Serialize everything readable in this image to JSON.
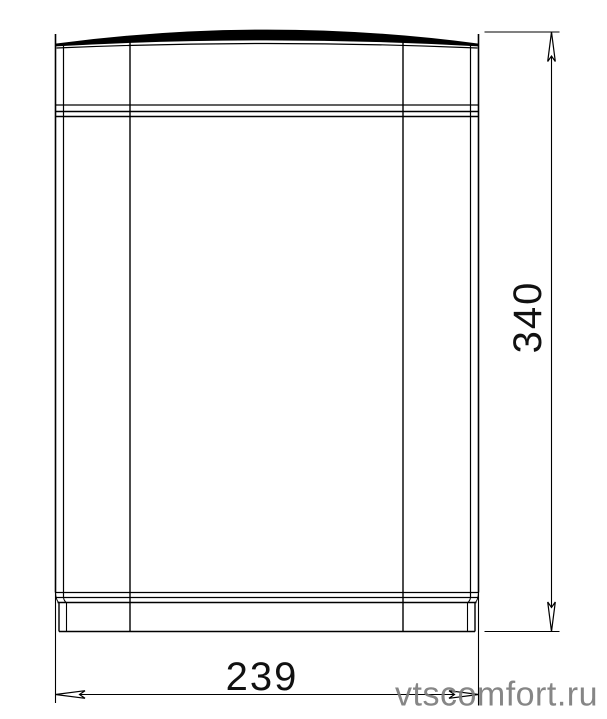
{
  "page": {
    "background": "#ffffff"
  },
  "drawing": {
    "line_color": "#000000",
    "dimensions": {
      "height": {
        "value": "340"
      },
      "width": {
        "value": "239"
      }
    },
    "watermark": {
      "text": "vtscomfort.ru",
      "color": "#7a7a7a"
    }
  }
}
